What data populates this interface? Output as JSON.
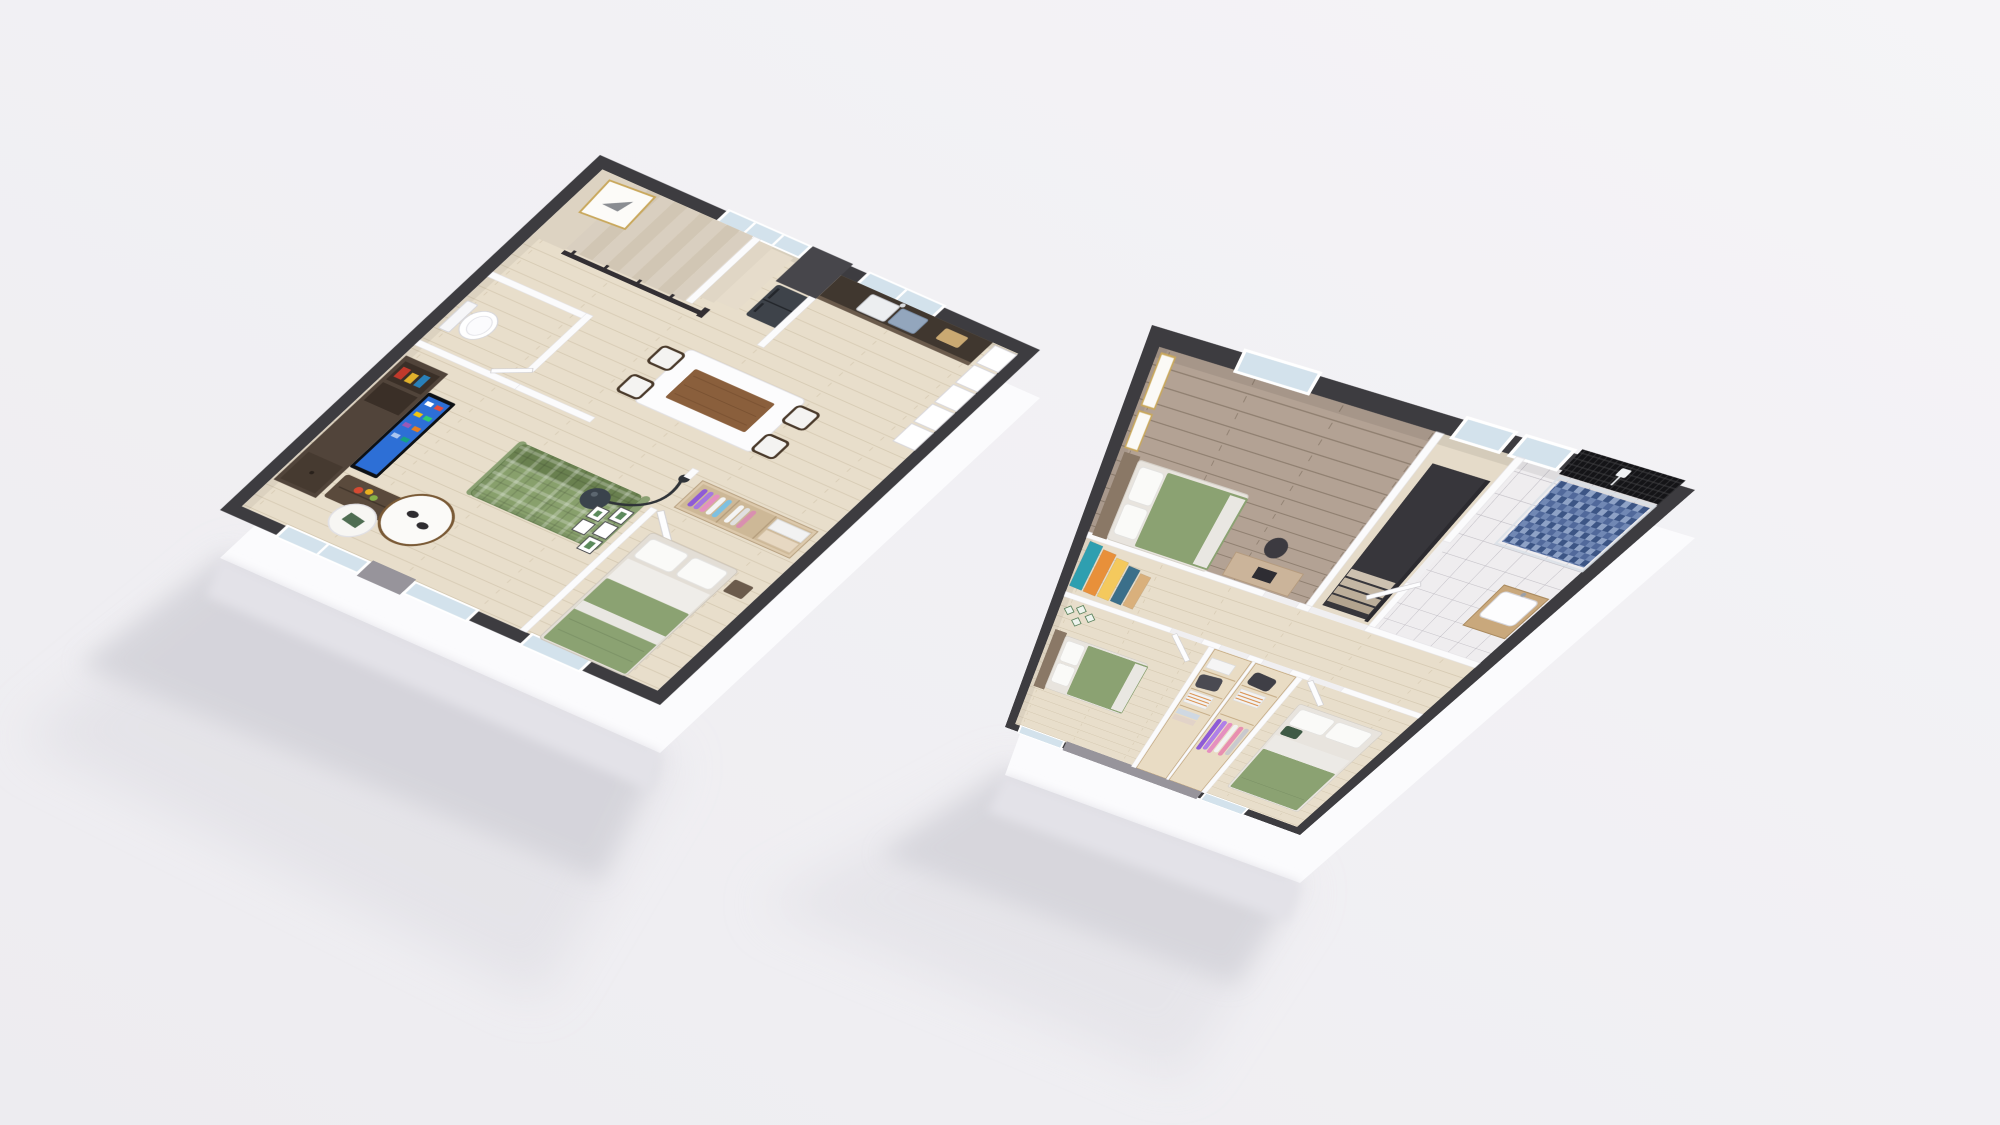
{
  "scene": {
    "title": "3D cutaway floor plan render of a two-storey home, two floors shown side by side",
    "background_color": "#f1f0f3",
    "floors": [
      {
        "id": "ground-floor",
        "label": "Ground floor 3D plan (left)",
        "rooms": [
          {
            "name": "staircase-hall",
            "furniture": [
              "l-shaped-staircase",
              "dark-wood-railing",
              "gold-framed-artwork"
            ]
          },
          {
            "name": "kitchen",
            "furniture": [
              "dark-fridge",
              "dark-counter-with-double-sink",
              "kitchen-window",
              "white-open-shelves",
              "chimney-block"
            ]
          },
          {
            "name": "dining-area",
            "furniture": [
              "white-table-with-wood-inlay",
              "four-dark-chairs-white-seats"
            ]
          },
          {
            "name": "wc",
            "furniture": [
              "toilet"
            ]
          },
          {
            "name": "living-room",
            "furniture": [
              "dark-media-wall",
              "tv-blue-screen",
              "green-plaid-sofa",
              "round-coffee-table-with-cups",
              "small-side-table",
              "arc-floor-lamp",
              "gallery-wall-frames",
              "fruit-bowl"
            ]
          },
          {
            "name": "bedroom",
            "furniture": [
              "green-bed-white-stripe",
              "open-wardrobe-hanging-clothes",
              "storage-boxes",
              "window"
            ]
          },
          {
            "name": "facade",
            "furniture": [
              "french-door-windows",
              "sliding-glass-doors",
              "grey-concrete-pier"
            ]
          }
        ]
      },
      {
        "id": "upper-floor",
        "label": "Upper floor 3D plan (right)",
        "rooms": [
          {
            "name": "master-bedroom",
            "furniture": [
              "green-bed",
              "wood-headboard",
              "gold-frames",
              "desk-with-chair",
              "window",
              "dark-wood-floor"
            ]
          },
          {
            "name": "stair-landing",
            "furniture": [
              "stair-opening",
              "dark-railing",
              "windows"
            ]
          },
          {
            "name": "bathroom",
            "furniture": [
              "black-mosaic-shower-wall",
              "shower-head",
              "blue-mosaic-shower-floor",
              "white-tile-floor",
              "wood-vanity-white-basin",
              "window"
            ]
          },
          {
            "name": "hallway",
            "furniture": [
              "leaning-sunset-art-panels"
            ]
          },
          {
            "name": "bedroom-2",
            "furniture": [
              "green-bed",
              "botanical-wall-decor",
              "window"
            ]
          },
          {
            "name": "walk-in-closet-left",
            "furniture": [
              "wood-shelving",
              "dark-bag",
              "striped-boxes",
              "folded-clothes"
            ]
          },
          {
            "name": "walk-in-closet-right",
            "furniture": [
              "wood-shelving",
              "dark-bag",
              "striped-boxes",
              "hanging-clothes-purple-pink"
            ]
          },
          {
            "name": "bedroom-3",
            "furniture": [
              "green-bed",
              "dark-green-accent-pillow",
              "window"
            ]
          }
        ]
      }
    ],
    "palette": {
      "background": "#f1f0f3",
      "exterior_wall_cap": "#3d3c40",
      "interior_wall": "#fbfbfc",
      "wood_floor_light": "#e8decb",
      "wood_floor_dark": "#b3a294",
      "bed_green": "#8ba272",
      "sofa_green": "#7d9464",
      "tv_screen_blue": "#2d6fd6",
      "shower_mosaic_blue": "#51699b",
      "shower_wall_black": "#141417",
      "vanity_wood": "#c9a87c",
      "gold_frame": "#c9a85c",
      "glass": "#d3e2ec",
      "grey_pier": "#97949b"
    }
  }
}
